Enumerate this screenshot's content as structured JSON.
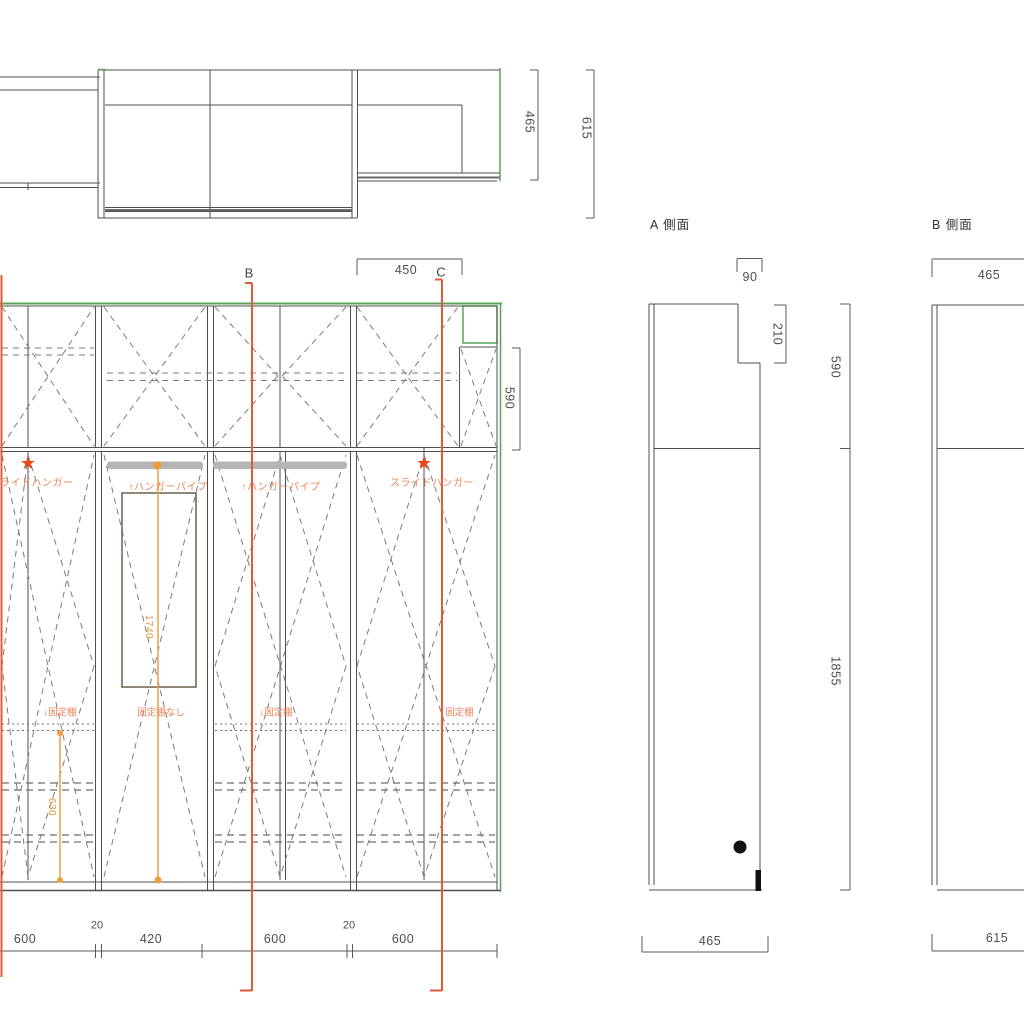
{
  "colors": {
    "line_gray": "#4f4f4f",
    "dash_gray": "#7b7b7b",
    "green_accent": "#58a558",
    "section_orange": "#e05c38",
    "dim_amber": "#eda23f",
    "label_orange": "#ef8257",
    "star_red": "#e8481c",
    "hanger_bar_gray": "#b5b5b5",
    "pipe_box_brown": "#6b6148",
    "knob_black": "#111111"
  },
  "plan": {
    "depth_right": "465",
    "depth_total": "615"
  },
  "elevation": {
    "section_b": "B",
    "section_c": "C",
    "dim_450": "450",
    "dim_590": "590",
    "bottom_dims": {
      "d1": "600",
      "g1": "20",
      "d2": "420",
      "d3": "600",
      "g2": "20",
      "d4": "600"
    },
    "labels": {
      "slide_hanger_left": "ライドハンガー",
      "hanger_pipe_1": "↑ハンガーパイプ",
      "hanger_pipe_2": "↑ハンガーパイプ",
      "slide_hanger_right": "スライドハンガー",
      "fixed_shelf_1": "↓固定棚",
      "no_fixed_shelf": "固定棚なし",
      "fixed_shelf_2": "↓固定棚",
      "fixed_shelf_3": "↓固定棚",
      "pipe_len": "1740",
      "shelf_len": "630"
    },
    "star_glyph": "★"
  },
  "side_a": {
    "title": "A 側面",
    "dim_90": "90",
    "dim_210": "210",
    "dim_590": "590",
    "dim_1855": "1855",
    "dim_465": "465"
  },
  "side_b": {
    "title": "B 側面",
    "dim_465": "465",
    "dim_615": "615"
  }
}
